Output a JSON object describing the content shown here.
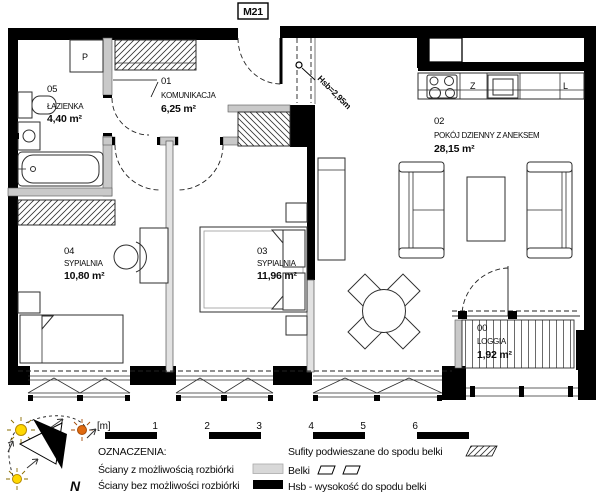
{
  "title": "M21",
  "rooms": [
    {
      "num": "01",
      "name": "KOMUNIKACJA",
      "area": "6,25 m²"
    },
    {
      "num": "02",
      "name": "POKÓJ DZIENNY Z ANEKSEM",
      "area": "28,15 m²"
    },
    {
      "num": "03",
      "name": "SYPIALNIA",
      "area": "11,96 m²"
    },
    {
      "num": "04",
      "name": "SYPIALNIA",
      "area": "10,80 m²"
    },
    {
      "num": "05",
      "name": "ŁAZIENKA",
      "area": "4,40 m²"
    },
    {
      "num": "00",
      "name": "LOGGIA",
      "area": "1,92 m²"
    }
  ],
  "annotations": {
    "beam_height": "Hsb=2,95m",
    "washing_machine": "P",
    "sink": "Z",
    "fridge": "L"
  },
  "compass": {
    "north": "N"
  },
  "scalebar": {
    "unit": "[m]",
    "ticks": [
      "1",
      "2",
      "3",
      "4",
      "5",
      "6"
    ]
  },
  "legend": {
    "heading": "OZNACZENIA:",
    "walls_removable": "Ściany z możliwością rozbiórki",
    "walls_fixed": "Ściany bez możliwości rozbiórki",
    "suspended_ceilings": "Sufity podwieszane do spodu belki",
    "beams": "Belki",
    "hsb_note": "Hsb - wysokość do spodu belki"
  },
  "colors": {
    "wall": "#000000",
    "removable_wall": "#c9c9c9",
    "sun_yellow": "#ffd800",
    "sun_orange": "#e06a10"
  }
}
